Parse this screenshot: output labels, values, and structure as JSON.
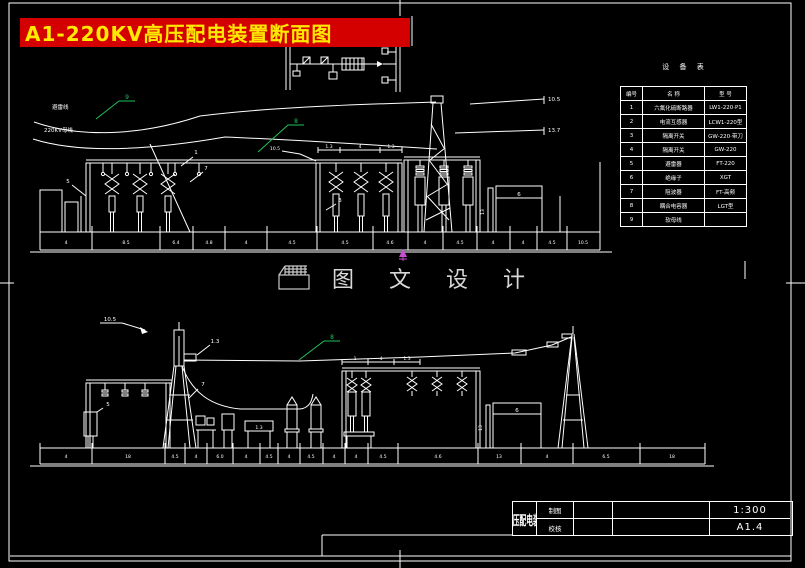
{
  "colors": {
    "background": "#000000",
    "line": "#ffffff",
    "banner_bg": "#d40000",
    "banner_text": "#ffe900",
    "callout_green": "#21c35a",
    "cursor_magenta": "#c44fd0",
    "watermark": "#d8d8d8"
  },
  "banner": {
    "title": "A1-220KV高压配电装置断面图"
  },
  "watermark": {
    "text": "图 文 设 计"
  },
  "equipment_table": {
    "caption": "设 备 表",
    "headers": [
      "编号",
      "名  称",
      "型  号"
    ],
    "rows": [
      {
        "no": "1",
        "name": "六氟化硫断路器",
        "model": "LW1-220·P1"
      },
      {
        "no": "2",
        "name": "电流互感器",
        "model": "LCW1-220型"
      },
      {
        "no": "3",
        "name": "隔离开关",
        "model": "GW-220·带刀"
      },
      {
        "no": "4",
        "name": "隔离开关",
        "model": "GW-220"
      },
      {
        "no": "5",
        "name": "避雷器",
        "model": "FT-220"
      },
      {
        "no": "6",
        "name": "绝缘子",
        "model": "XGT"
      },
      {
        "no": "7",
        "name": "阻波器",
        "model": "FT-高频"
      },
      {
        "no": "8",
        "name": "耦合电容器",
        "model": "LGT型"
      },
      {
        "no": "9",
        "name": "软母线",
        "model": ""
      }
    ]
  },
  "top_view": {
    "wire_label_1": "避雷线",
    "wire_label_2": "220KV母线",
    "green_1": "9",
    "green_2": "8",
    "callout_5": "5",
    "callout_1": "1",
    "callout_7": "7",
    "callout_3": "3",
    "callout_beam": "10.5",
    "beam_dims": [
      "1.3",
      "4",
      "1.3"
    ],
    "building_label": "6",
    "height_label": "13",
    "elev_1": "10.5",
    "elev_2": "13.7",
    "dims": [
      "4",
      "8.5",
      "6.4",
      "4.8",
      "4",
      "4.5",
      "4.5",
      "4.6",
      "4",
      "4.5",
      "4",
      "4",
      "4.5",
      "10.5"
    ]
  },
  "bottom_view": {
    "mast_callout": "10.5",
    "device_callout": "1.3",
    "green_1": "8",
    "callout_5": "5",
    "callout_7": "7",
    "bench_label": "1.3",
    "building_label": "6",
    "height_label": "13",
    "beam_dims": [
      "1",
      "4",
      "1.3"
    ],
    "dims": [
      "4",
      "18",
      "4.5",
      "4",
      "6.0",
      "4",
      "4.5",
      "4",
      "4.5",
      "4",
      "4",
      "4.5",
      "4.6",
      "13",
      "4",
      "6.5",
      "18"
    ]
  },
  "title_block": {
    "maker_label": "制图",
    "checker_label": "校核",
    "drawing_title": "220KV高压配电装置断面图",
    "scale": "1:300",
    "sheet_no": "A1.4"
  }
}
